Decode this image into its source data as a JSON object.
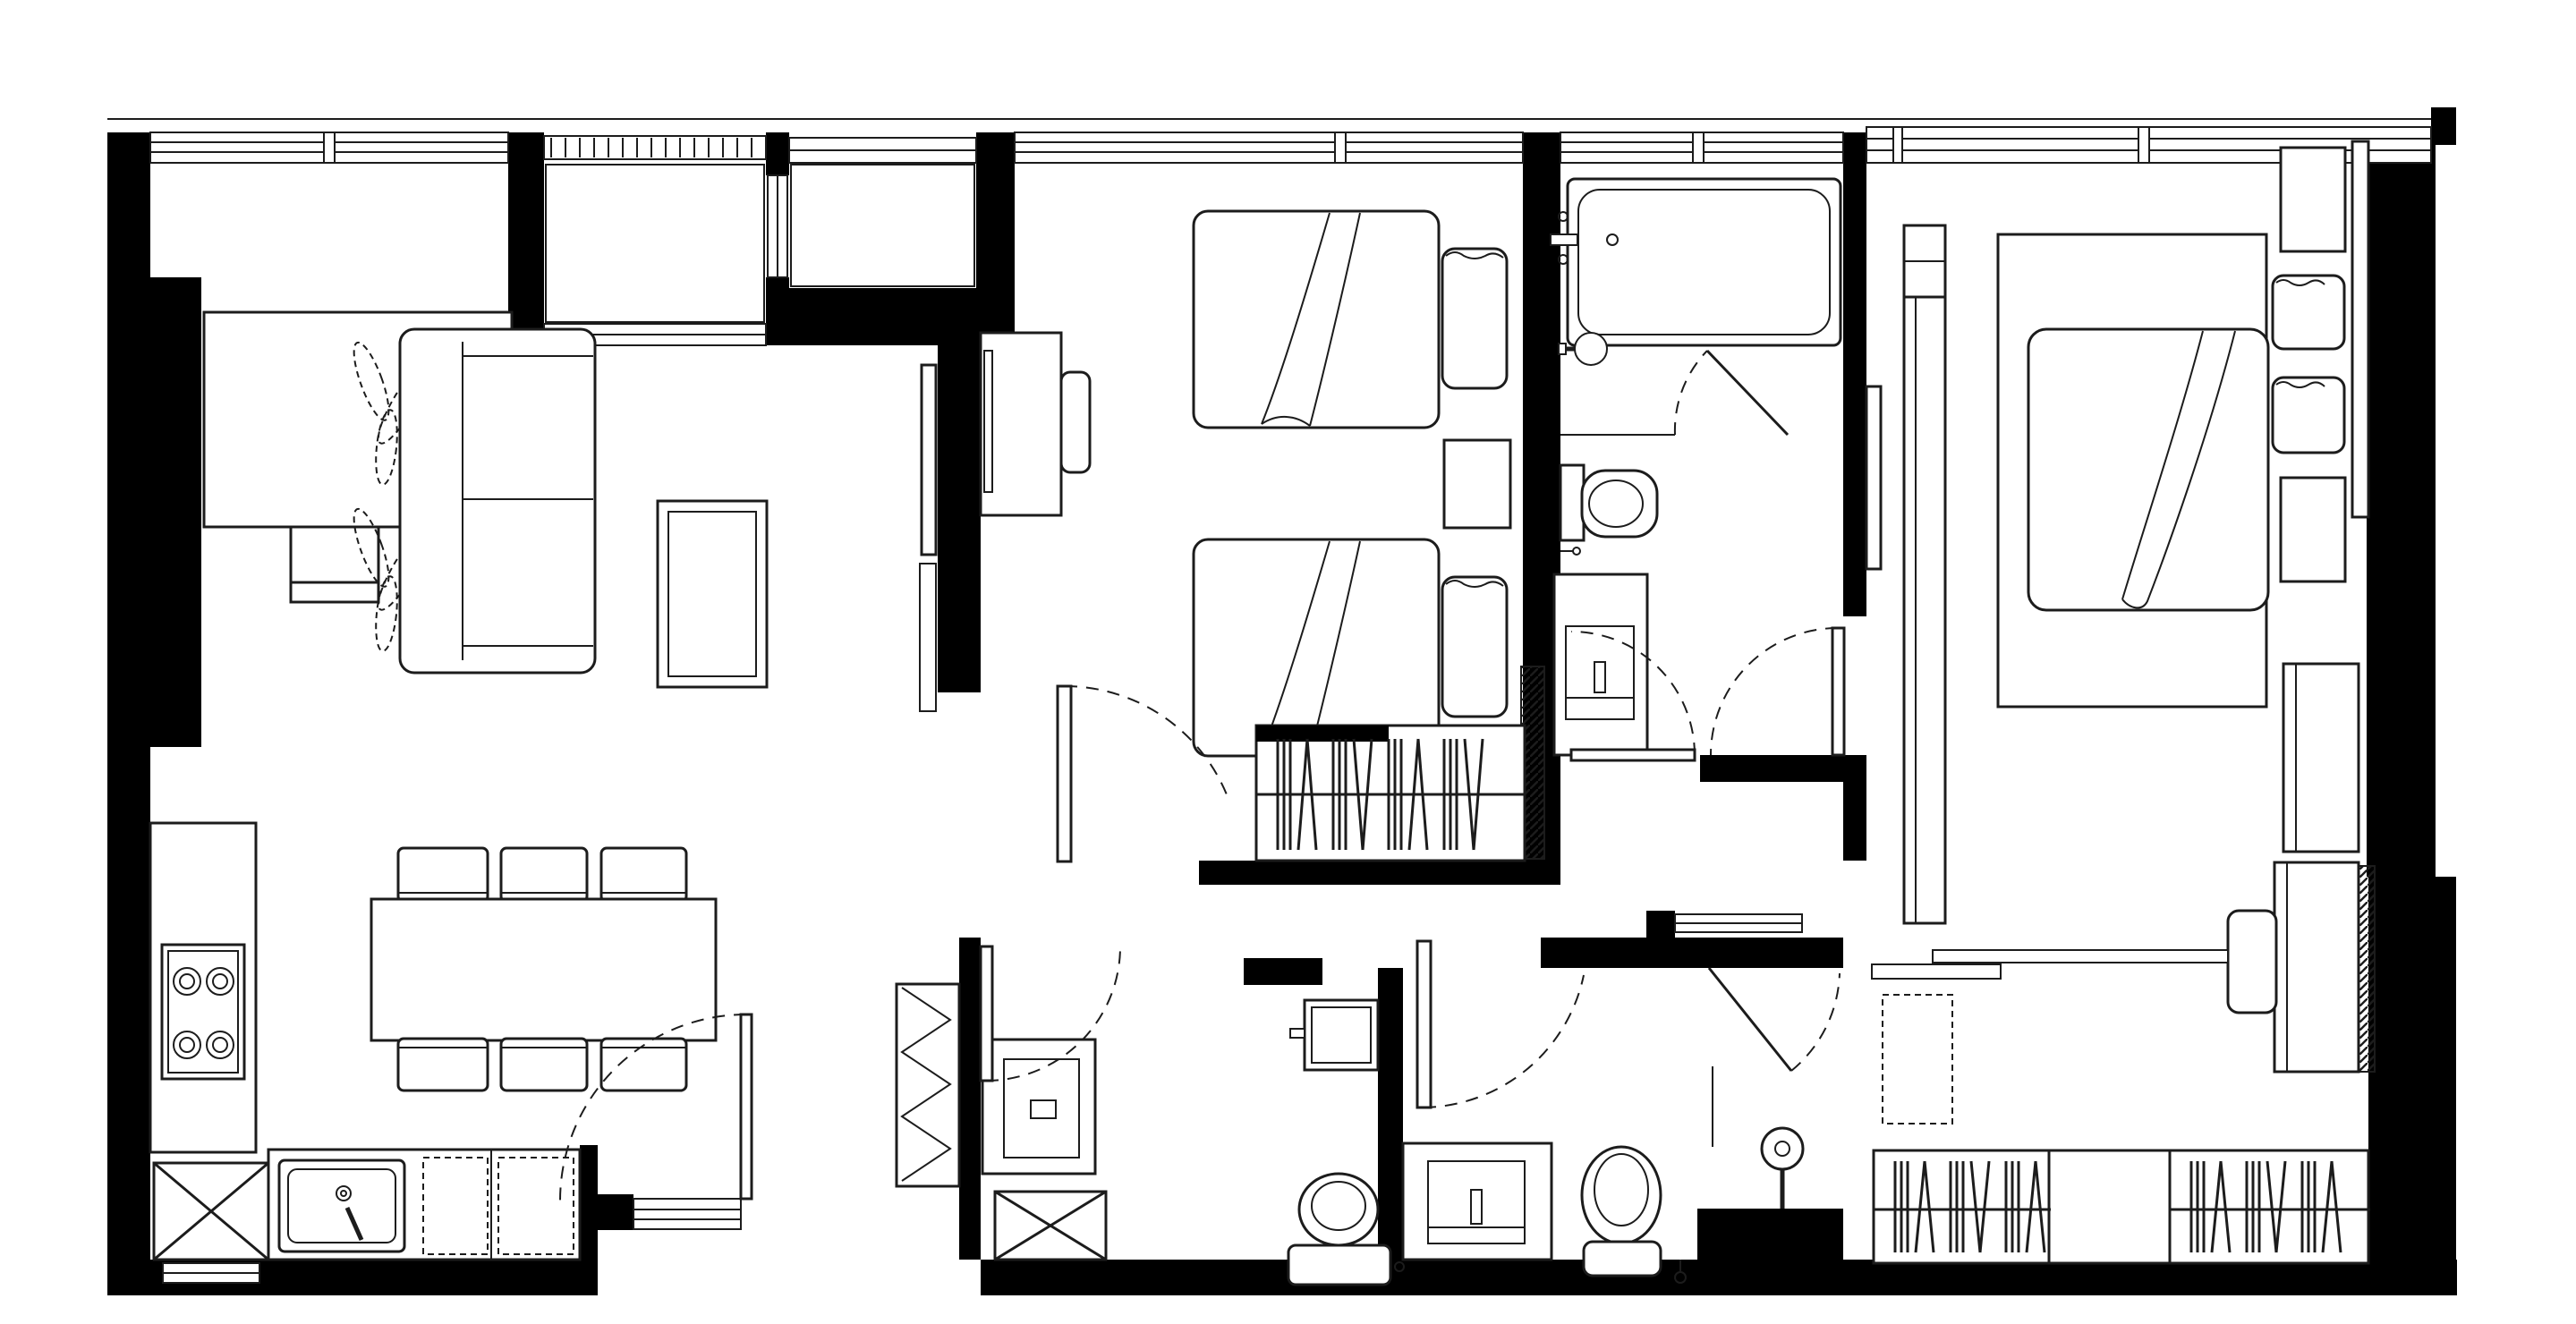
{
  "title": "Two-bedroom apartment floor plan",
  "colors": {
    "wall": "#000000",
    "line": "#1c1c1c",
    "bg": "#ffffff"
  },
  "drawing": {
    "type": "architectural-floor-plan",
    "style": "black and white line drawing, solid black walls, furnished",
    "legend_conventions": {
      "solid_black": "structural wall",
      "triple_line_band": "window",
      "tick_band": "louvered vent",
      "dashed_arc": "door swing",
      "dashed_rect": "appliance / open space below counter",
      "x_box": "shaft / appliance void",
      "diagonal_hatch": "new partition",
      "strokes_on_rod": "clothes hanging in wardrobe"
    }
  },
  "rooms": [
    {
      "id": "living-dining",
      "name": "Living / Dining",
      "fixtures": [
        "sideboard",
        "tv-console",
        "floor-plants",
        "sofa",
        "coffee-table",
        "wall-tv",
        "media-shelf",
        "dining-table",
        "dining-chairs-x6"
      ]
    },
    {
      "id": "kitchen",
      "name": "Kitchen",
      "fixtures": [
        "worktop",
        "cooktop-4-burner",
        "kitchen-sink",
        "under-counter-appliance-dashed-x2",
        "appliance-void-x-box"
      ]
    },
    {
      "id": "entry",
      "name": "Entry vestibule",
      "fixtures": [
        "entrance-door",
        "threshold",
        "shoe-cabinet-zigzag"
      ]
    },
    {
      "id": "balcony-niches",
      "name": "Facade niches",
      "fixtures": [
        "louvered-ac-ledge",
        "window-niche",
        "slot-window"
      ]
    },
    {
      "id": "bedroom-2",
      "name": "Twin bedroom",
      "fixtures": [
        "desk",
        "desk-chair",
        "monitor",
        "single-bed-x2",
        "pillow-x2",
        "nightstand",
        "wardrobe-hanging",
        "door"
      ]
    },
    {
      "id": "bathroom-1",
      "name": "Bathroom with bathtub",
      "fixtures": [
        "bathtub",
        "tub-faucet",
        "glass-screen-door",
        "round-wall-basin",
        "toilet",
        "vanity-counter",
        "door"
      ]
    },
    {
      "id": "bathroom-2",
      "name": "Guest WC",
      "fixtures": [
        "washing-machine-cabinet",
        "duct-shaft-x-box",
        "wall-basin",
        "toilet",
        "door"
      ]
    },
    {
      "id": "bathroom-3",
      "name": "Master bathroom",
      "fixtures": [
        "vanity-with-sink",
        "toilet",
        "shower-head",
        "glass-screen",
        "door-north",
        "door-east"
      ]
    },
    {
      "id": "master-bedroom",
      "name": "Master bedroom",
      "fixtures": [
        "wall-tv",
        "tall-wardrobe",
        "double-bed",
        "pillow-x2",
        "headboard",
        "nightstand-x2",
        "dresser",
        "desk",
        "desk-chair",
        "hatched-partition",
        "door"
      ]
    },
    {
      "id": "walk-in-closet",
      "name": "Walk-in closet corridor",
      "fixtures": [
        "shelf-ledge-x2",
        "dashed-open-box",
        "hanging-wardrobe-x2",
        "open-shelf-box"
      ]
    }
  ]
}
